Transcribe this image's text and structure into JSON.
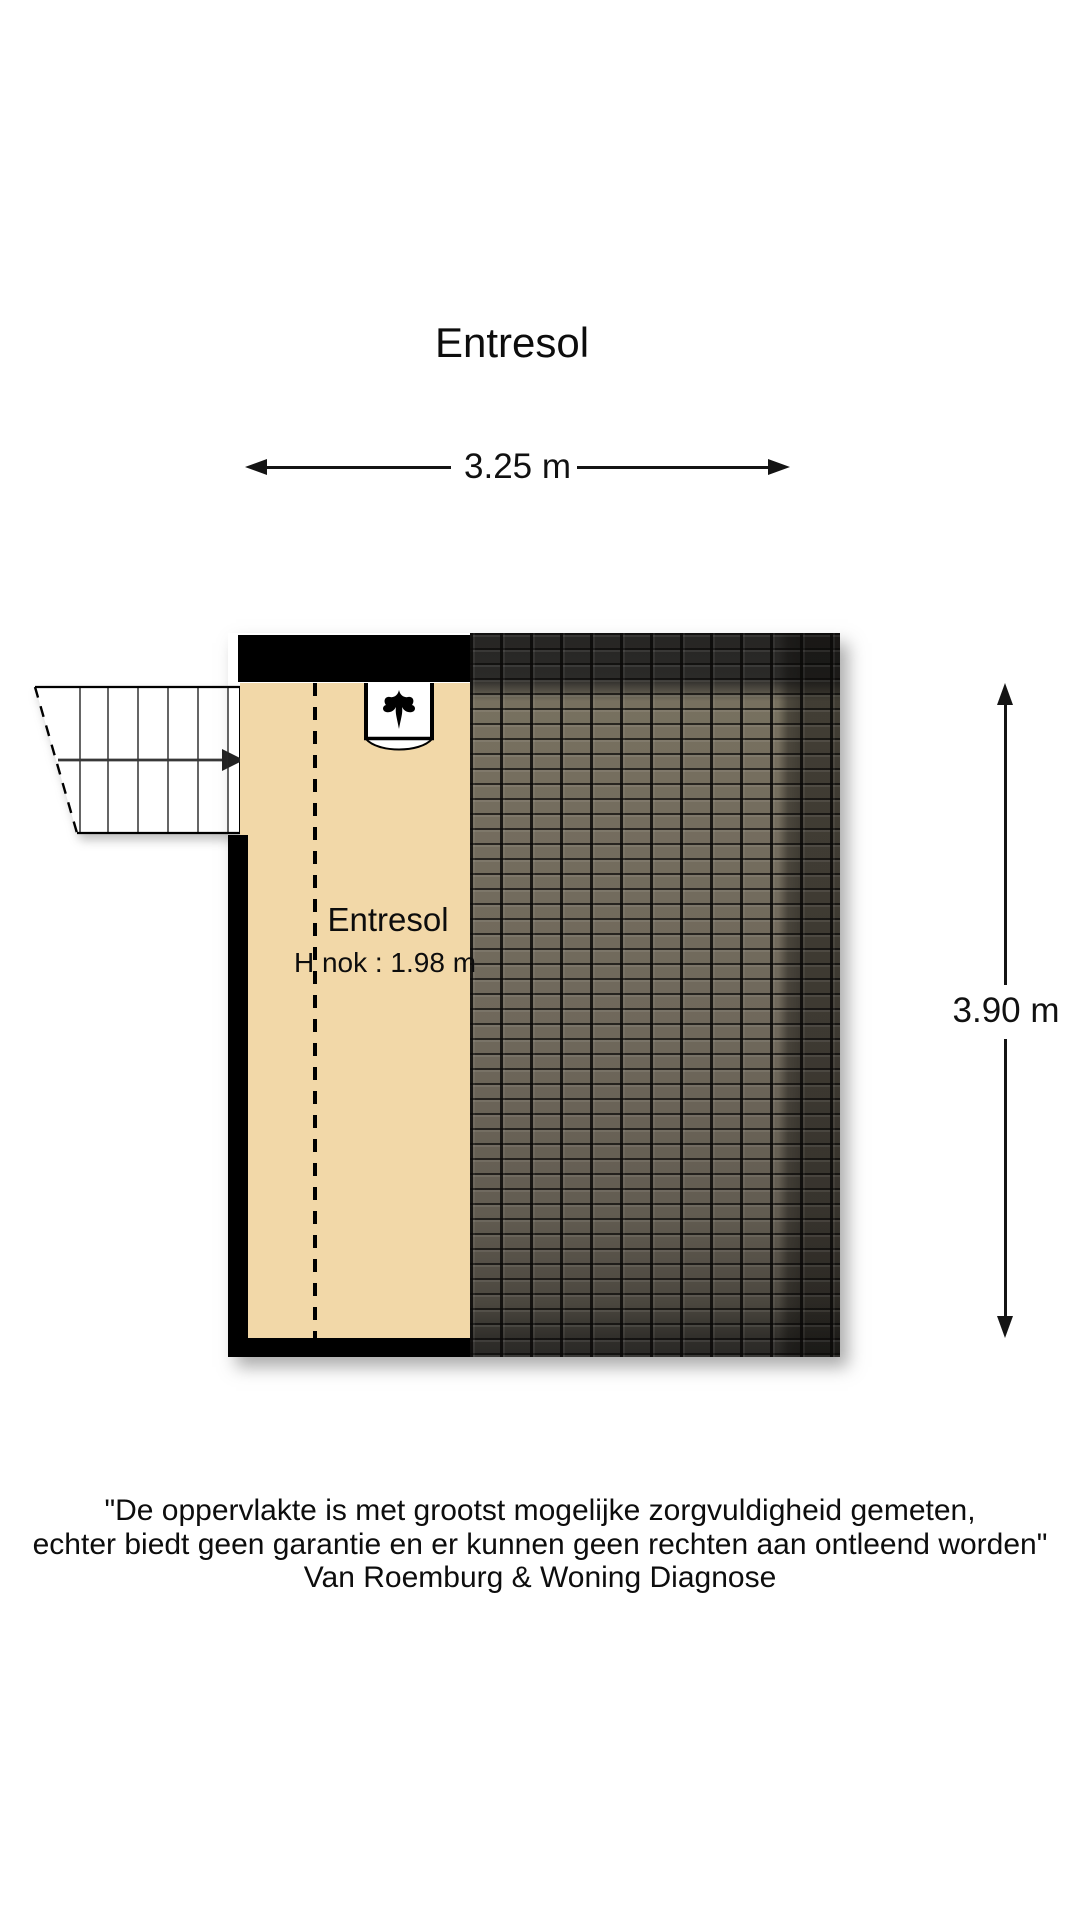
{
  "title": "Entresol",
  "dims": {
    "width": "3.25 m",
    "height": "3.90 m"
  },
  "room": {
    "name": "Entresol",
    "ridge_height": "H nok : 1.98 m"
  },
  "stairs": {
    "direction_icon": "arrow-right-icon",
    "step_count": 7
  },
  "roof_window": {
    "ornament_icon": "flame-ornament-icon"
  },
  "disclaimer": {
    "line1": "\"De oppervlakte is met grootst mogelijke zorgvuldigheid gemeten,",
    "line2": "echter biedt geen garantie en er kunnen geen rechten aan ontleend worden\"",
    "line3": "Van Roemburg & Woning Diagnose"
  },
  "colors": {
    "floor": "#f2d8a8",
    "wall": "#000000",
    "roof_base": "#6f685b",
    "roof_dark": "#2b2a27",
    "line": "#141414"
  }
}
